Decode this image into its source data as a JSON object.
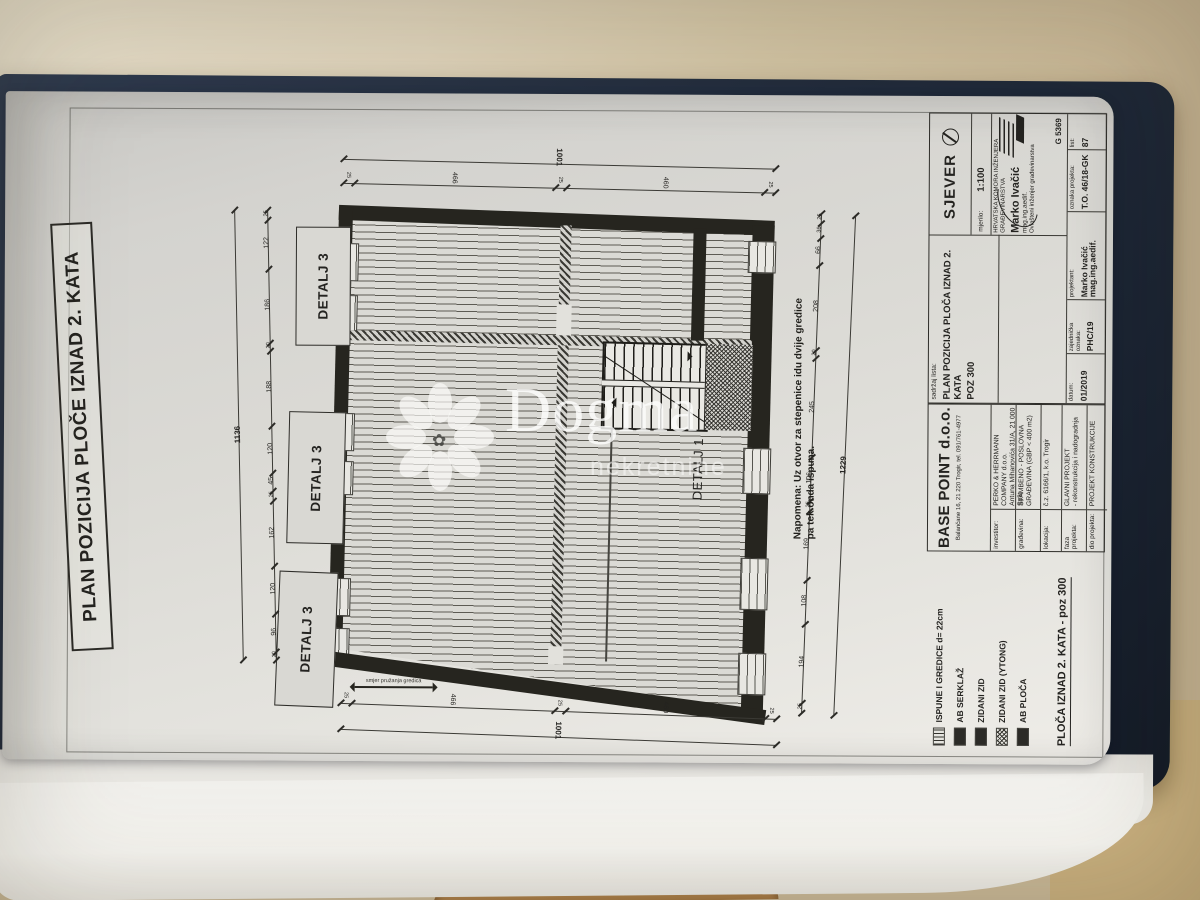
{
  "photo": {
    "watermark_brand": "Dogma",
    "watermark_sub": "nekretnine"
  },
  "sheet": {
    "title": "PLAN POZICIJA PLOČE IZNAD 2. KATA",
    "note_line1": "Napomena: Uz otvor za stepenice idu dvije gredice",
    "note_line2": "pa tek onda ispuna.",
    "joist_dir_label": "smjer pružanja gredica",
    "detail_label_1": "DETALJ 1",
    "detail_label_3": "DETALJ 3"
  },
  "plan_dims": {
    "left_total": "1136",
    "left_segments": [
      "25",
      "122",
      "186",
      "20",
      "188",
      "120",
      "45",
      "25",
      "162",
      "120",
      "96",
      "20"
    ],
    "right_total": "1229",
    "right_segments": [
      "25",
      "36",
      "66",
      "208",
      "20",
      "245",
      "106",
      "25",
      "169",
      "108",
      "194",
      "25"
    ],
    "top_total": "1001",
    "top_segments": [
      "25",
      "466",
      "25",
      "460",
      "25"
    ],
    "bottom_total": "1001",
    "bottom_segments": [
      "25",
      "466",
      "25",
      "460",
      "25"
    ]
  },
  "legend": {
    "items": [
      {
        "label": "ISPUNE I GREDICE d= 22cm",
        "swatch": "lines"
      },
      {
        "label": "AB SERKLAŽ",
        "swatch": "solid"
      },
      {
        "label": "ZIDANI ZID",
        "swatch": "solid"
      },
      {
        "label": "ZIDANI ZID (YTONG)",
        "swatch": "cross"
      },
      {
        "label": "AB PLOČA",
        "swatch": "solid"
      }
    ],
    "caption": "PLOČA IZNAD 2. KATA - poz 300"
  },
  "titleblock": {
    "company": "BASE POINT d.o.o.",
    "company_address": "Balančane 16, 21 220 Trogir,  tel. 091/761-4977",
    "rows": [
      {
        "label": "investitor:",
        "value": "PERKO & HERRMANN COMPANY d.o.o.",
        "value2": "Antuna Mihanovića 31/A, 21 000 Split"
      },
      {
        "label": "građevina:",
        "value": "STAMBENO - POSLOVNA",
        "value2": "GRAĐEVINA (GBP < 400 m2)"
      },
      {
        "label": "lokacija:",
        "value": "č.z. 6166/1, k.o. Trogir"
      },
      {
        "label": "faza projekta:",
        "value": "GLAVNI PROJEKT",
        "value2": "- rekonstrukcija i nadogradnja"
      },
      {
        "label": "dio projekta:",
        "value": "PROJEKT KONSTRUKCIJE"
      }
    ],
    "content_label": "sadržaj lista:",
    "content_value": "PLAN POZICIJA PLOČA IZNAD 2. KATA",
    "content_pos": "POZ 300",
    "north_label": "SJEVER",
    "scale_label": "mjerilo:",
    "scale_value": "1:100",
    "chamber": "HRVATSKA KOMORA INŽENJERA GRAĐEVINARSTVA",
    "engineer_name": "Marko Ivačić",
    "engineer_degree": "mag.ing.aedif.",
    "engineer_role": "Ovlašteni inženjer građevinarstva",
    "license_no": "G 5369",
    "meta": [
      {
        "label": "datum:",
        "value": "01/2019"
      },
      {
        "label": "zajednička oznaka:",
        "value": "PHC/19"
      },
      {
        "label": "projektant:",
        "value": "Marko Ivačić mag.ing.aedif."
      },
      {
        "label": "oznaka projekta:",
        "value": "T.O. 46/18-GK"
      },
      {
        "label": "list:",
        "value": "87"
      }
    ]
  },
  "colors": {
    "binder_navy": "#212b3b",
    "paper": "#dddcd7",
    "table_beige": "#c9b897",
    "ink": "#26251f"
  }
}
